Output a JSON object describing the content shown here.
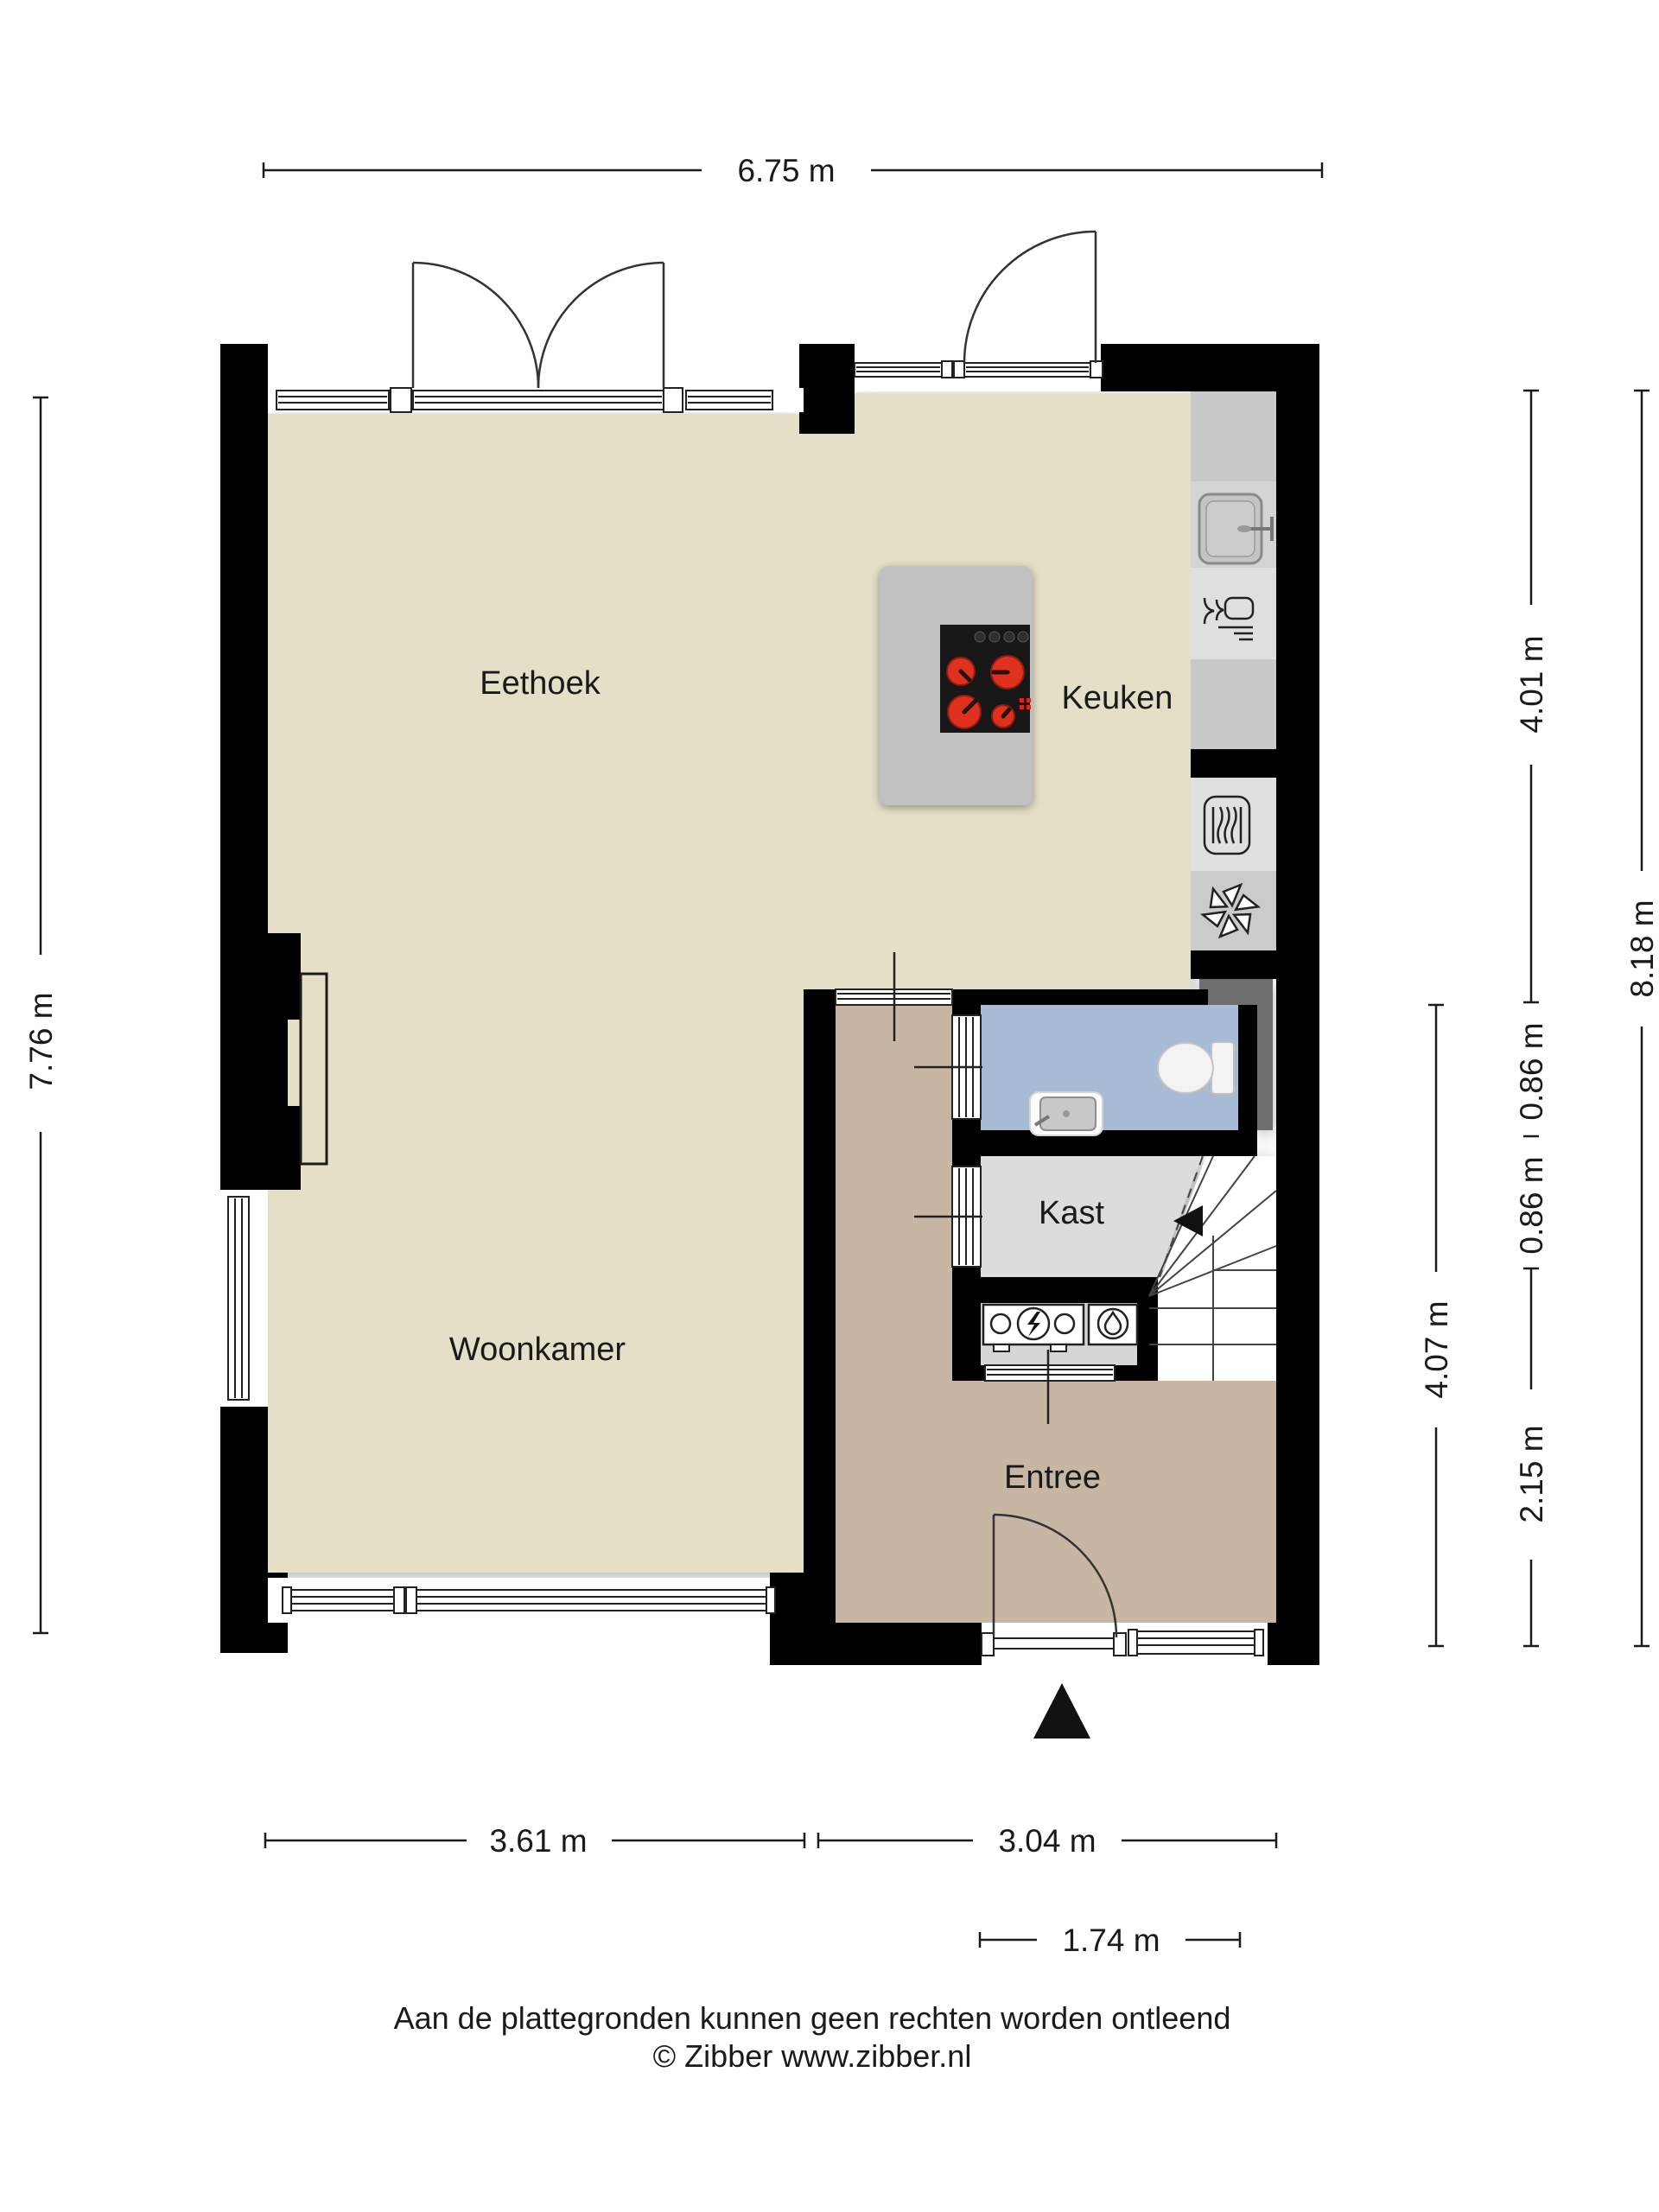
{
  "plan": {
    "rooms": [
      {
        "id": "eethoek",
        "label": "Eethoek"
      },
      {
        "id": "keuken",
        "label": "Keuken"
      },
      {
        "id": "woonkamer",
        "label": "Woonkamer"
      },
      {
        "id": "kast",
        "label": "Kast"
      },
      {
        "id": "entree",
        "label": "Entree"
      }
    ],
    "colors": {
      "wall": "#000000",
      "living_floor": "#e5dfc7",
      "entree_floor": "#c7b6a4",
      "toilet_floor": "#a8bbd5",
      "kast_floor": "#dcdcdc",
      "meter_floor": "#d6d6d6",
      "counter": "#c9c9c9",
      "counter_sink": "#d4d4d4",
      "counter_dishwasher": "#dfdfdf",
      "counter_oven": "#e0e0e0",
      "counter_fan": "#cbcbcb",
      "island": "#c1c1c1",
      "niche": "#6e6e6e",
      "stove": "#171717",
      "burner": "#e0301e",
      "stairs": "#ffffff",
      "text": "#1a1a1a",
      "white": "#ffffff"
    },
    "icons": {
      "stove-icon": "4-burner ceramic cooktop",
      "sink-icon": "kitchen sink with faucet",
      "dishwasher-icon": "glass-and-fork dishwasher symbol",
      "oven-icon": "oven",
      "ventilation-icon": "extractor fan star",
      "toilet-icon": "wall-hung toilet",
      "washbasin-icon": "small washbasin",
      "electricity-meter-icon": "electricity meter with lightning bolt",
      "water-meter-icon": "water meter with droplet",
      "stairs-icon": "winder staircase with direction arrow",
      "entrance-arrow-icon": "entrance direction triangle"
    }
  },
  "dimensions": {
    "top": [
      {
        "label": "6.75 m"
      }
    ],
    "left": [
      {
        "label": "7.76 m"
      }
    ],
    "right": [
      {
        "label": "4.01 m"
      },
      {
        "label": "0.86 m"
      },
      {
        "label": "0.86 m"
      },
      {
        "label": "2.15 m"
      },
      {
        "label": "4.07 m"
      },
      {
        "label": "8.18 m"
      }
    ],
    "bottom": [
      {
        "label": "3.61 m"
      },
      {
        "label": "3.04 m"
      },
      {
        "label": "1.74 m"
      }
    ]
  },
  "footer": {
    "disclaimer": "Aan de plattegronden kunnen geen rechten worden ontleend",
    "copyright": "© Zibber www.zibber.nl"
  }
}
